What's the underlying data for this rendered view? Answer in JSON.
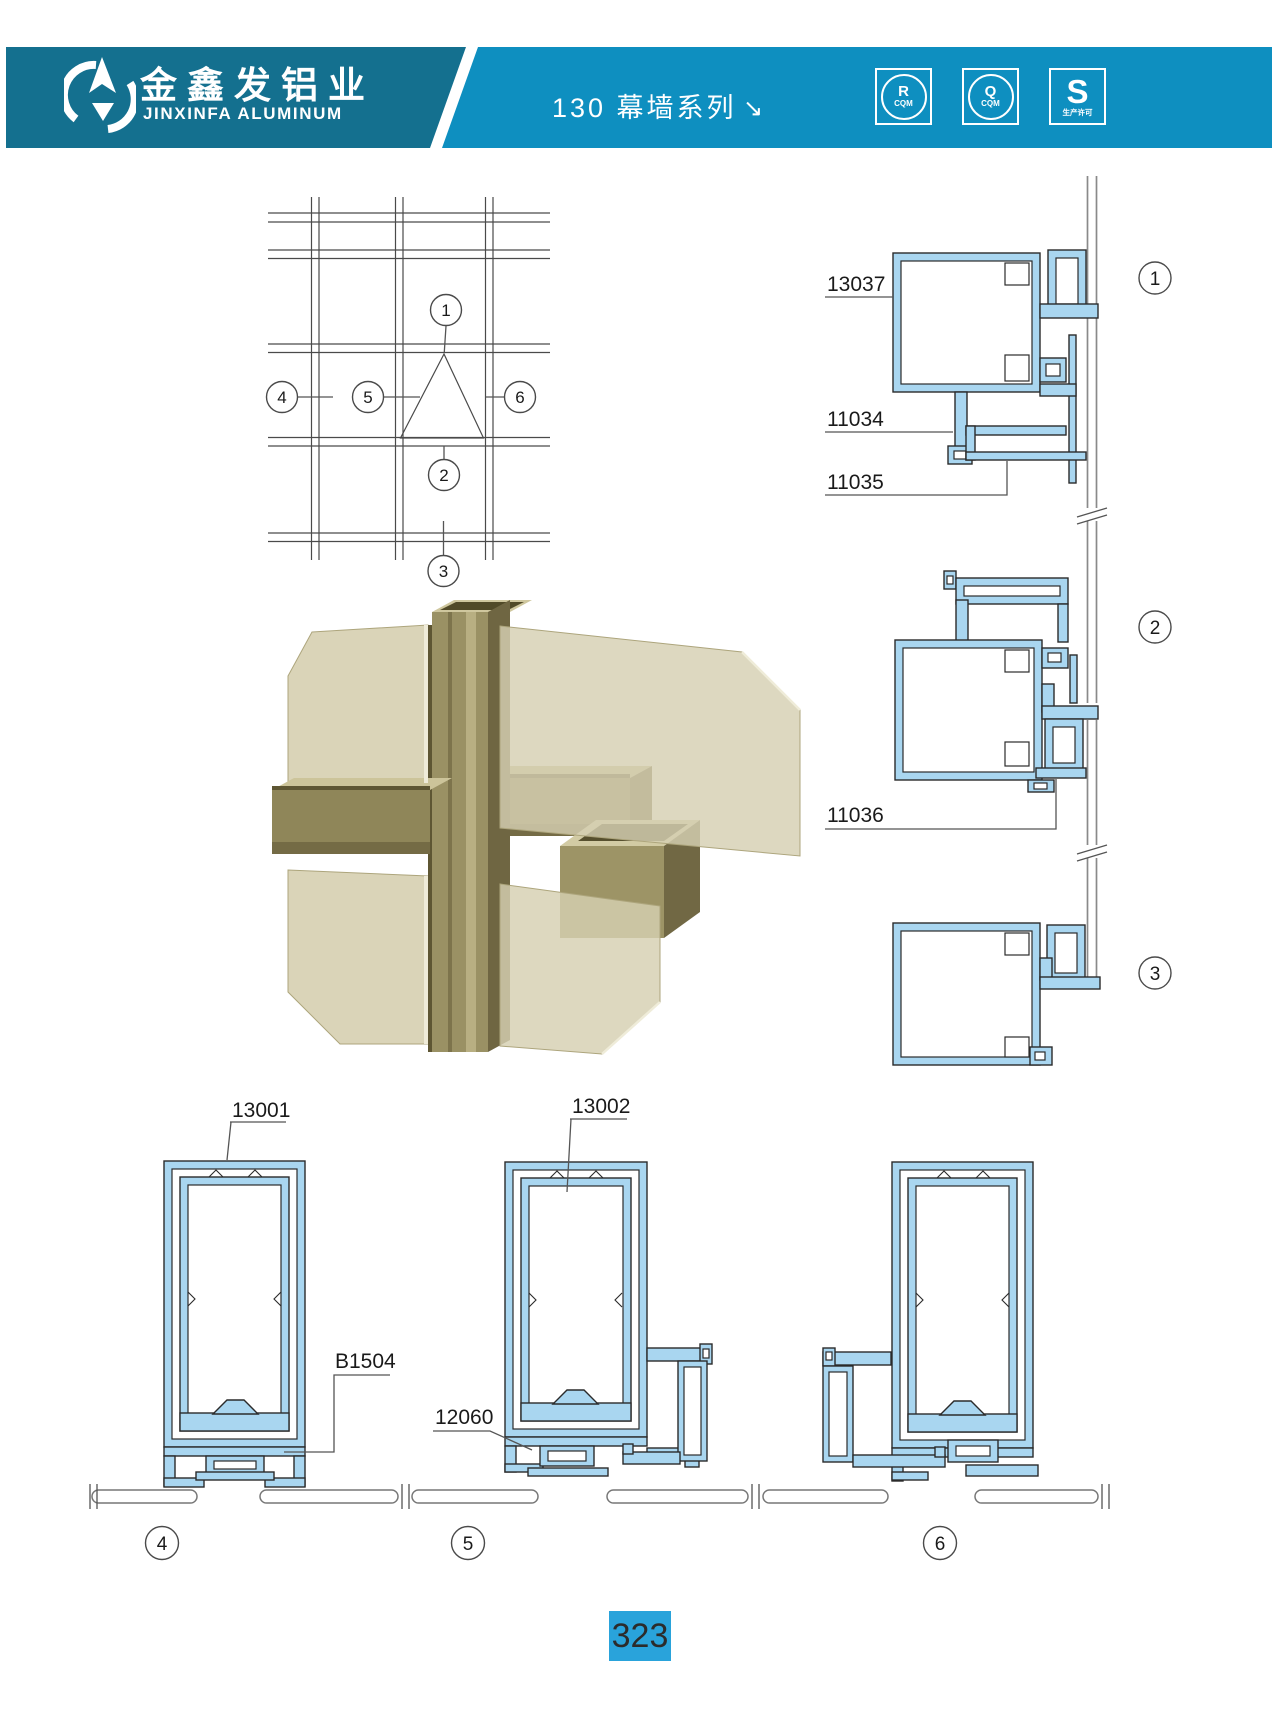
{
  "header": {
    "company_cn": "金鑫发铝业",
    "company_en": "JINXINFA ALUMINUM",
    "series_title": "130 幕墙系列",
    "arrow_glyph": "↘",
    "certs": {
      "c1_letter": "R",
      "c1_sub": "CQM",
      "c2_letter": "Q",
      "c2_sub": "CQM",
      "c3_letter": "S",
      "c3_sub": "生产许可"
    }
  },
  "plan": {
    "markers": {
      "m1": "1",
      "m2": "2",
      "m3": "3",
      "m4": "4",
      "m5": "5",
      "m6": "6"
    }
  },
  "sections": {
    "labels": {
      "l13037": "13037",
      "l11034": "11034",
      "l11035": "11035",
      "l11036": "11036",
      "l13001": "13001",
      "lB1504": "B1504",
      "l13002": "13002",
      "l12060": "12060"
    },
    "markers": {
      "m1": "1",
      "m2": "2",
      "m3": "3",
      "m4": "4",
      "m5": "5",
      "m6": "6"
    }
  },
  "footer": {
    "page_number": "323"
  },
  "colors": {
    "banner_dark": "#14708F",
    "banner_light": "#0E8FC0",
    "profile_fill": "#A9D6F0",
    "profile_stroke": "#2B2B2B",
    "drawing_line": "#4A4A4A",
    "glass_line": "#8A8A8A",
    "page_tab_bg": "#29A3DB",
    "bronze_face": "#9A9164",
    "bronze_dark": "#6F6642",
    "bronze_light": "#CFC79E",
    "glass_tint": "#D8D2B5"
  }
}
